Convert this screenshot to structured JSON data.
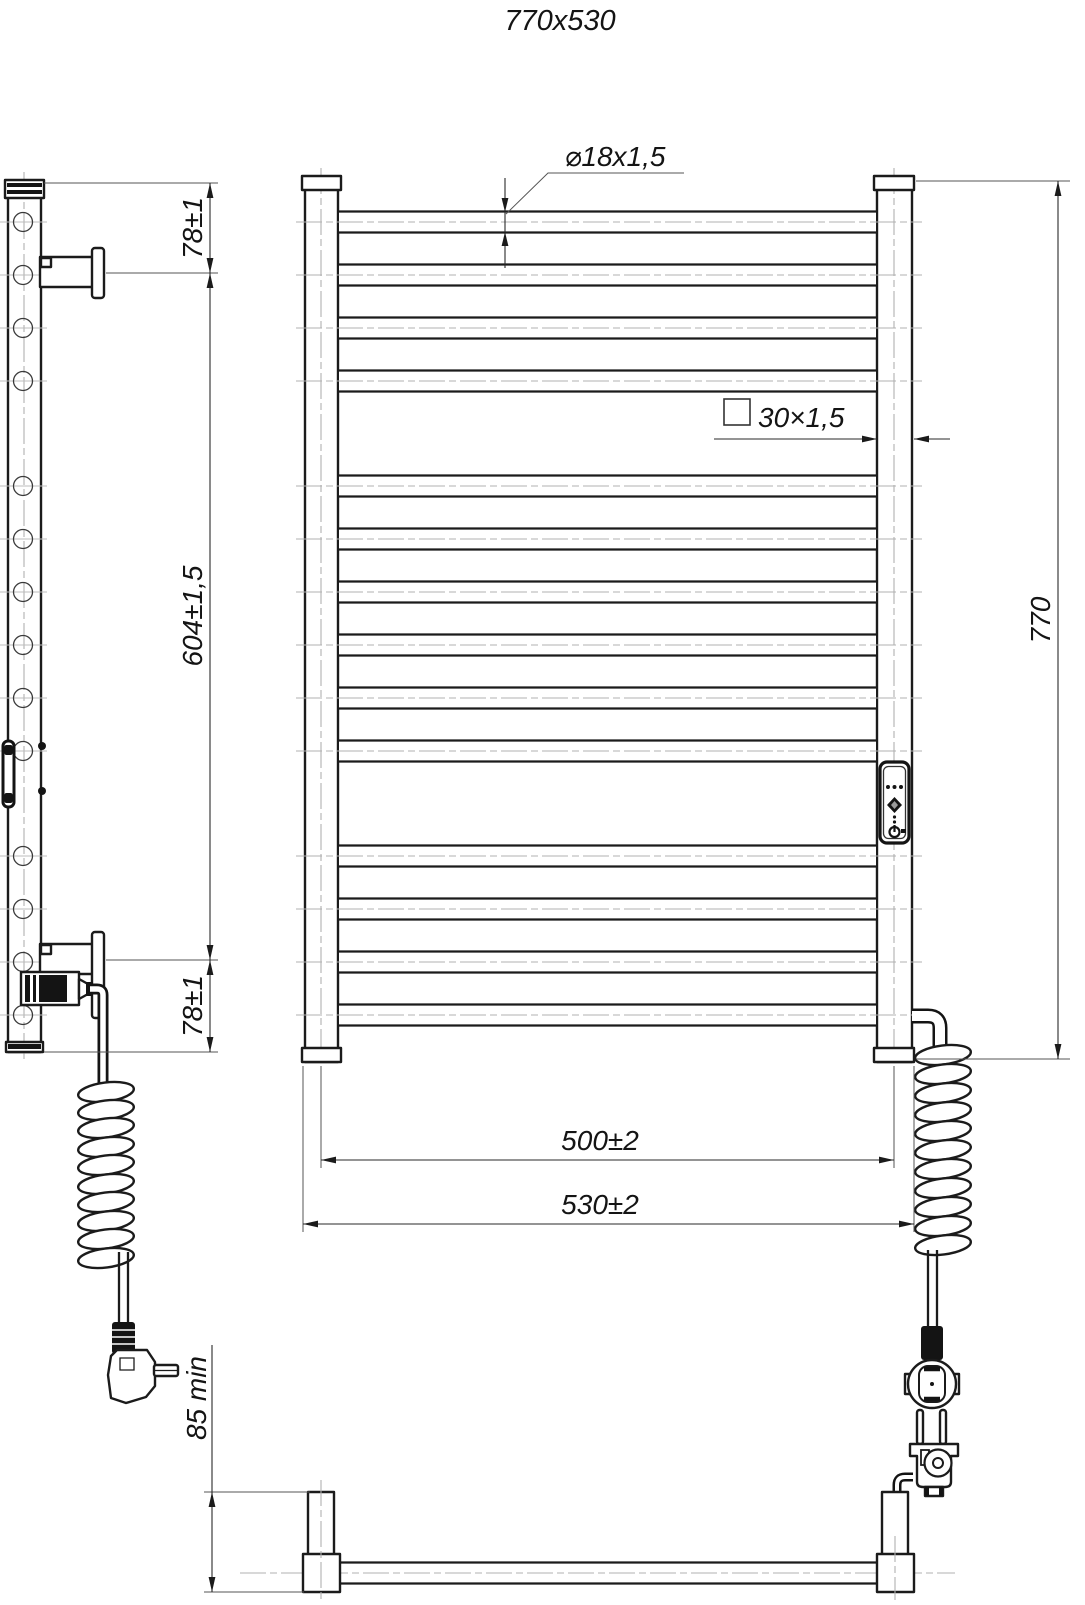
{
  "title": "770x530",
  "colors": {
    "line": "#1b1b1b",
    "centerline": "#b0b0b0",
    "background": "#ffffff"
  },
  "front_view": {
    "tube_annotation": "⌀18x1,5",
    "profile_annotation": "30×1,5",
    "height_dim": "770",
    "center_width_dim": "500±2",
    "overall_width_dim": "530±2"
  },
  "side_view": {
    "top_bracket_dim": "78±1",
    "bracket_span_dim": "604±1,5",
    "bottom_bracket_dim": "78±1",
    "wall_clearance_dim": "85 min"
  }
}
